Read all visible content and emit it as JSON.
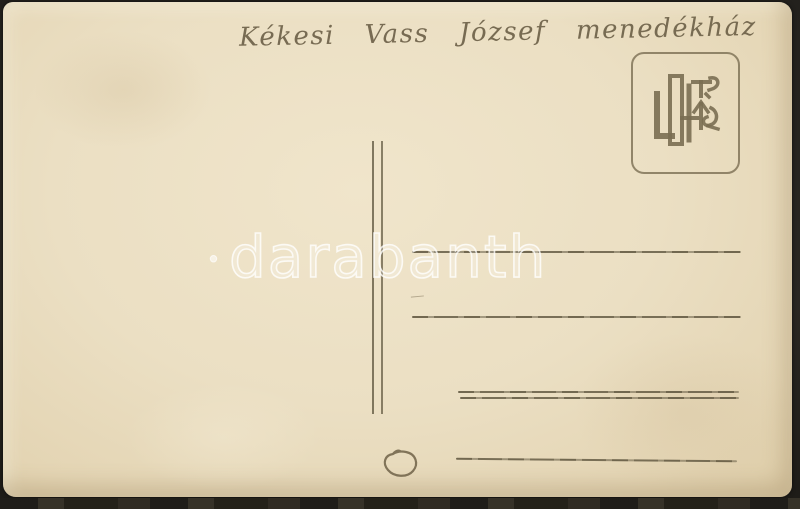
{
  "postcard": {
    "handwriting_top": "Kékesi Vass József menedékház",
    "watermark": {
      "bullet": "•",
      "text": "darabanth"
    },
    "pencil_letter": "D",
    "icons": {
      "stamp_box_monogram": "manufacturer-monogram-icon"
    },
    "colors": {
      "paper": "#ebdfc3",
      "pencil": "#6a5e46",
      "ruled_line": "#5c533c",
      "stamp_box_border": "#7a6e52",
      "watermark_white": "rgba(255,255,255,0.78)",
      "scan_background": "#2a2722"
    }
  }
}
